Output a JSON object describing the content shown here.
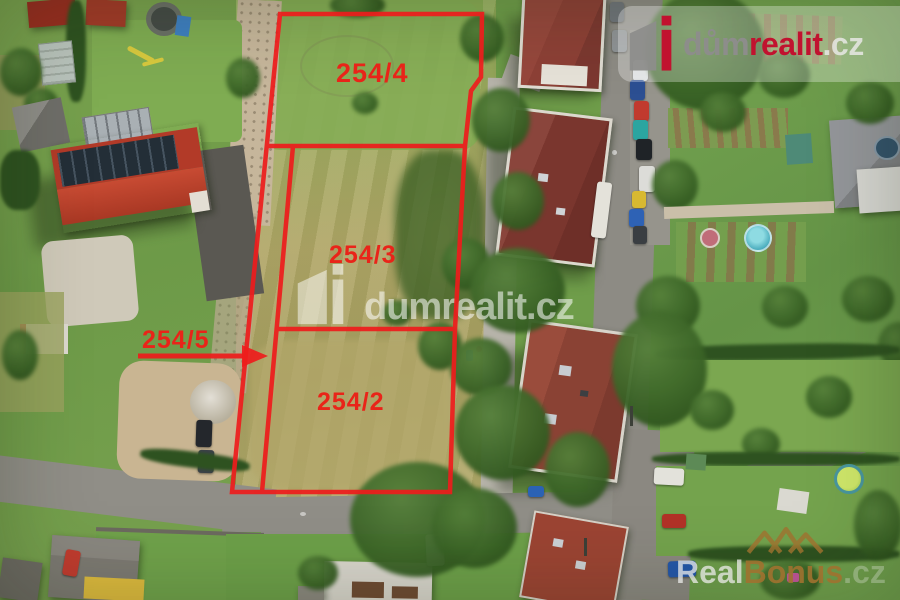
{
  "colors": {
    "outline_red": "#ee1c1c",
    "label_red": "#e92419",
    "dum_gray": "#8d8d8b",
    "realit_red": "#c1122f",
    "cz_light": "#e8e8e5",
    "bonus_gold": "#a0722f",
    "real_silver": "#ececea",
    "watermark_white": "#ffffff"
  },
  "overlay": {
    "parcels": [
      {
        "label": "254/4"
      },
      {
        "label": "254/3"
      },
      {
        "label": "254/2"
      },
      {
        "label": "254/5"
      }
    ]
  },
  "branding": {
    "center_watermark": "dumrealit.cz",
    "topright": {
      "word1": "dům",
      "word2": "realit",
      "word3": ".cz"
    },
    "bottomright": {
      "word1": "Real",
      "word2": "Bonus",
      "word3": ".cz"
    }
  }
}
